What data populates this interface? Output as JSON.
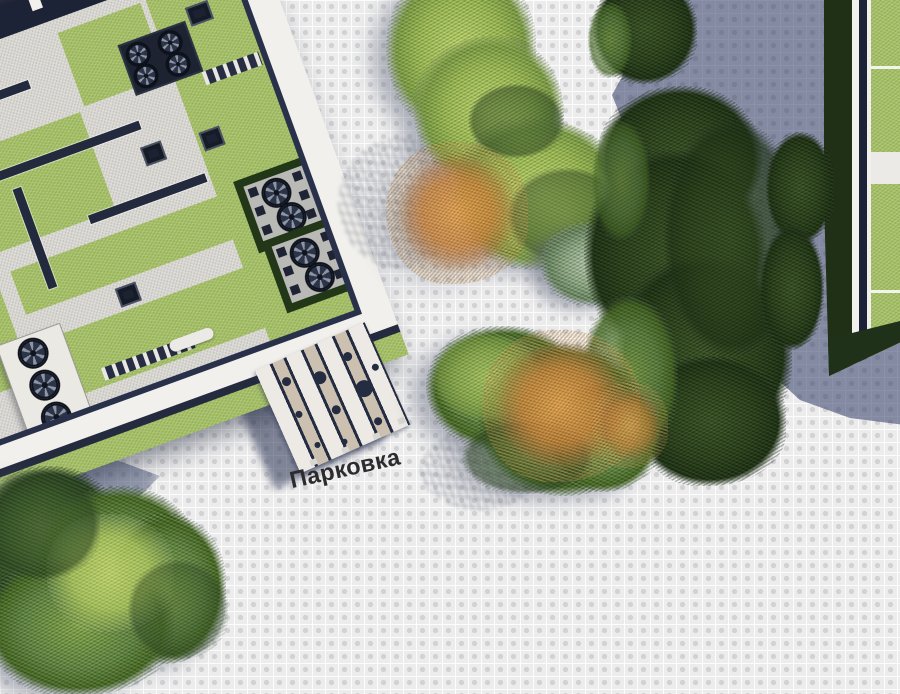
{
  "scene": {
    "type": "architectural-site-plan-top-down-render",
    "width_px": 900,
    "height_px": 694
  },
  "labels": {
    "parking": "Парковка"
  },
  "palette": {
    "pave": "#ececec",
    "pave_dot": "#d2d2d4",
    "shadow_blue": "#46557e",
    "roof_gray": "#d8d6d1",
    "facade_navy": "#1d2336",
    "parapet_white": "#f1f0ec",
    "grass_green": "#a5c066",
    "foliage_light": "#bdd468",
    "foliage_dark": "#2a4119",
    "foliage_orange": "#cd8a45",
    "canopy_white": "#edeae5",
    "canopy_beige": "#ccc1b0",
    "canopy_navy": "#242c42",
    "label_ink": "#2c2c2e"
  },
  "objects": {
    "main_building": "green-roof building with HVAC fans, skylights, grass patches",
    "right_building": "neighboring green-roof building at right edge",
    "parking_canopy": "striped parking canopy with tree openings",
    "plaza": "tiled pedestrian plaza",
    "shadow_ne": "cast shadow of off-screen building, top-right",
    "shadow_nw": "cast shadow, top-left corner",
    "vegetation": "hedges, bushes, autumn trees"
  }
}
